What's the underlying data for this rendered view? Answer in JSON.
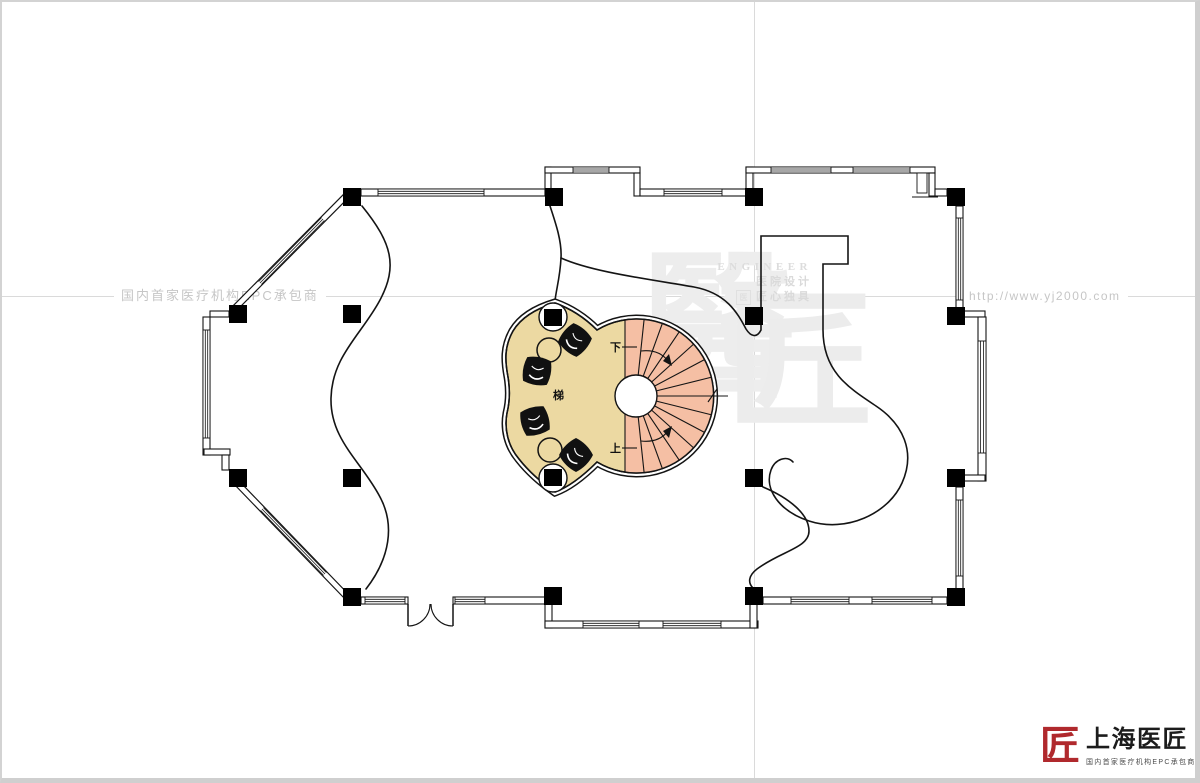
{
  "page": {
    "taglines": {
      "left": "国内首家医疗机构EPC承包商",
      "right": "http://www.yj2000.com"
    }
  },
  "watermark": {
    "engineer": "ENGINEER",
    "line1": "医院设计",
    "line2": "匠心独具",
    "seal_char": "医",
    "big1": "醫",
    "big2": "匠"
  },
  "plan": {
    "labels": {
      "down": "下",
      "up": "上",
      "stair": "梯"
    },
    "colors": {
      "lobby_fill": "#ECD9A2",
      "stair_fill": "#F5BFA4",
      "line": "#141414",
      "centerline": "#DADADA",
      "watermark_gray": "#EDEDED",
      "accent_red": "#B0292D"
    }
  },
  "logo": {
    "seal": "匠",
    "title": "上海医匠",
    "subtitle": "国内首家医疗机构EPC承包商"
  }
}
